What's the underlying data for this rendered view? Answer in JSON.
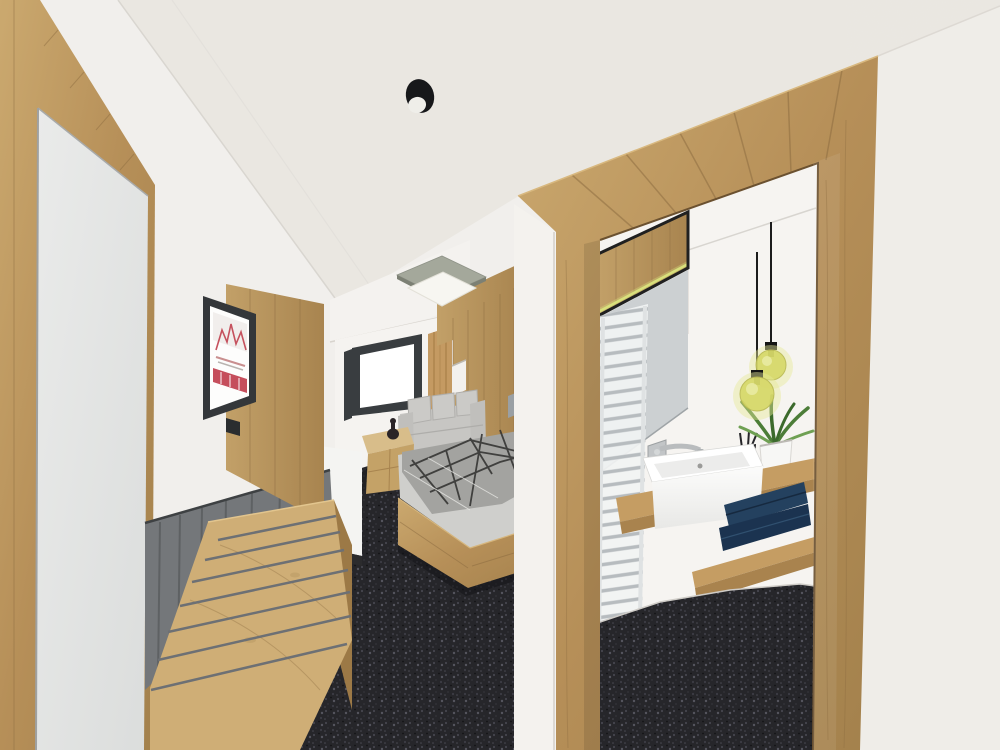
{
  "scene": {
    "kind": "architectural-3d-rendering",
    "subject": "hotel-room-interior-with-bathroom-vanity",
    "visible_text": "none"
  },
  "colors": {
    "wall": "#f1efec",
    "ceiling": "#eae7e1",
    "right_wall": "#efede8",
    "bulkhead": "#f4f2ef",
    "wood": "#b68f58",
    "wood_light": "#c9a873",
    "wood_dark": "#8a6a3f",
    "counter": "#c59d63",
    "counter_edge": "#a9834e",
    "barnwood": "#74777a",
    "carpet": "#26262a",
    "mirror": "#e4e5e4",
    "tv_frame": "#34373a",
    "tv_screen": "#fdfdfc",
    "logo_red": "#c03f4e",
    "sofa": "#c7c6c3",
    "bed_linen": "#cfcfcc",
    "duvet": "#a3a3a0",
    "duvet_print": "#2f2f2e",
    "window_frame": "#393d40",
    "curtain": "#c49a62",
    "bath_wall": "#f6f4f1",
    "panel_gray": "#ccd0d2",
    "radiator": "#f1f3f3",
    "radiator_bar": "#b7bcbf",
    "chrome": "#b9bcbe",
    "sink": "#fcfcfb",
    "towel": "#24415f",
    "towel_dark": "#1b3350",
    "plant": "#4c7d38",
    "pot": "#f7f7f5",
    "pendant_glass": "#d6d867",
    "pendant_glow": "#e6e89a",
    "cord": "#1c1c1c",
    "led": "#d8e07c",
    "niche": "#f3f1ee",
    "switch": "#9aa0a4",
    "cabinet": "#f4f4f2",
    "vase": "#2a2427",
    "spot_black": "#17181a",
    "lamp_top": "#a4a89b",
    "lamp_white": "#f7f6f1"
  },
  "objects": [
    "ceiling-spotlight",
    "square-ceiling-lamp",
    "wall-mirror",
    "flat-screen-tv",
    "tv-brand-logo",
    "wood-wall-panel",
    "barnwood-wainscot",
    "luggage-bench",
    "bedroom-carpet",
    "double-bed",
    "patterned-duvet",
    "wall-niche",
    "light-switch",
    "window",
    "curtain",
    "sofa",
    "cube-side-table",
    "decor-vase",
    "minibar-cabinet",
    "bathroom-doorway-frame",
    "towel-radiator",
    "vanity-mirror",
    "led-strip",
    "wall-faucet",
    "vessel-sink",
    "vanity-counter",
    "towel-shelf",
    "navy-towels",
    "potted-plant",
    "toothbrush-cup",
    "pendant-lights",
    "bathroom-floor",
    "right-wall"
  ]
}
